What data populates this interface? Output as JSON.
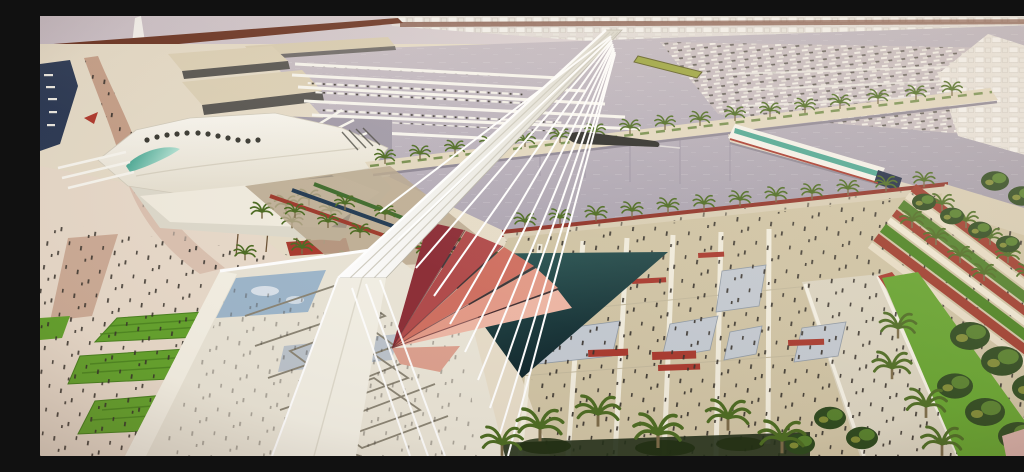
{
  "scene": {
    "description": "Aerial photograph of an architectural scale model of a seaport marina masterplan: an inclined white pylon with a fan of cable stays rises over red sail canopies and a switchback ramp, surrounded by a lavender water basin with marina docks and moored boats, a white wing-roofed pavilion with a teal skylight, palm-lined piers and promenades, a large striped esplanade dotted with people and red benches, and terraced gardens with dense palms on the right; behind the model runs a dark maroon table rail with a painted white city backdrop",
    "elements": [
      "backdrop-wall",
      "backdrop-city",
      "backdrop-tower",
      "model-edge-rail",
      "water-basin",
      "marina-docks",
      "moored-boats-field",
      "harbor-inlet",
      "warehouses",
      "tan-promenade",
      "wing-roof-building",
      "teal-skylight",
      "roof-skylight-dots",
      "building-shadow-palms",
      "pier-fan-rays",
      "palm-pier",
      "dark-boat",
      "yellow-boat",
      "ferry-terminal",
      "tree-promenade",
      "switchback-ramp",
      "glass-canopy",
      "shadow-triangle",
      "red-sail-canopy",
      "inclined-pylon",
      "cable-stays",
      "esplanade",
      "esplanade-stripes",
      "shade-canopies",
      "red-benches",
      "boulevard",
      "left-plaza",
      "lawn-panels",
      "right-terraces",
      "park-lawn",
      "right-park-trees",
      "crowd-figures",
      "photo-vignette"
    ]
  },
  "palette": {
    "wall": "#c8bdc5",
    "wallLight": "#ddd3d5",
    "sky": "#85b2d6",
    "rail": "#6a3322",
    "railLight": "#8a5440",
    "cityBg": "#e2dcd8",
    "cityBlockA": "#f7f5f1",
    "cityBlockB": "#e9e6df",
    "water": "#b5adb9",
    "waterLight": "#ccc2c8",
    "waterDark": "#a19aa8",
    "waterRight": "#c6bbbf",
    "sand": "#e6dcc8",
    "sandLight": "#efe7d6",
    "plazaPink": "#e9d9cc",
    "roofBeige": "#ddd1b6",
    "roofSide": "#565450",
    "shedRoof": "#d9cdb2",
    "tanPath": "#c49c86",
    "structWhite": "#f8f6ef",
    "structShade": "#dedacc",
    "mastWhite": "#ffffff",
    "glassBlue": "#9db6cb",
    "deckBlue": "#b3bdc9",
    "teal": "#2f9a84",
    "tealPale": "#bfe8da",
    "navyShadow": "#23304d",
    "sailDark": "#8c2d36",
    "sailMid": "#b04a4a",
    "sailLight": "#cf6f60",
    "sailPink": "#e39a87",
    "sailPale": "#edb6a4",
    "triTop": "#2c5a58",
    "triBottom": "#0f252b",
    "khaki": "#cfc3a4",
    "khakiLight": "#dcd2ba",
    "stripeWhite": "#f2eee0",
    "benchRed": "#a8392e",
    "canopyGrey": "#c3c9d1",
    "lawn": "#64a32d",
    "lawnDark": "#49821f",
    "parkGreen": "#4e7e28",
    "treeDark": "#2c481d",
    "treeMid": "#56802c",
    "palmFrond": "#4c6b22",
    "palmOlive": "#a3a73e",
    "trunk": "#7a6a48",
    "terraceRed": "#9e3a2c",
    "terracePath": "#e8ddc6",
    "boatDark": "#3c3832",
    "boatWhite": "#f4f1ea",
    "people": "#35302a",
    "ferryNose": "#1f2b46"
  }
}
